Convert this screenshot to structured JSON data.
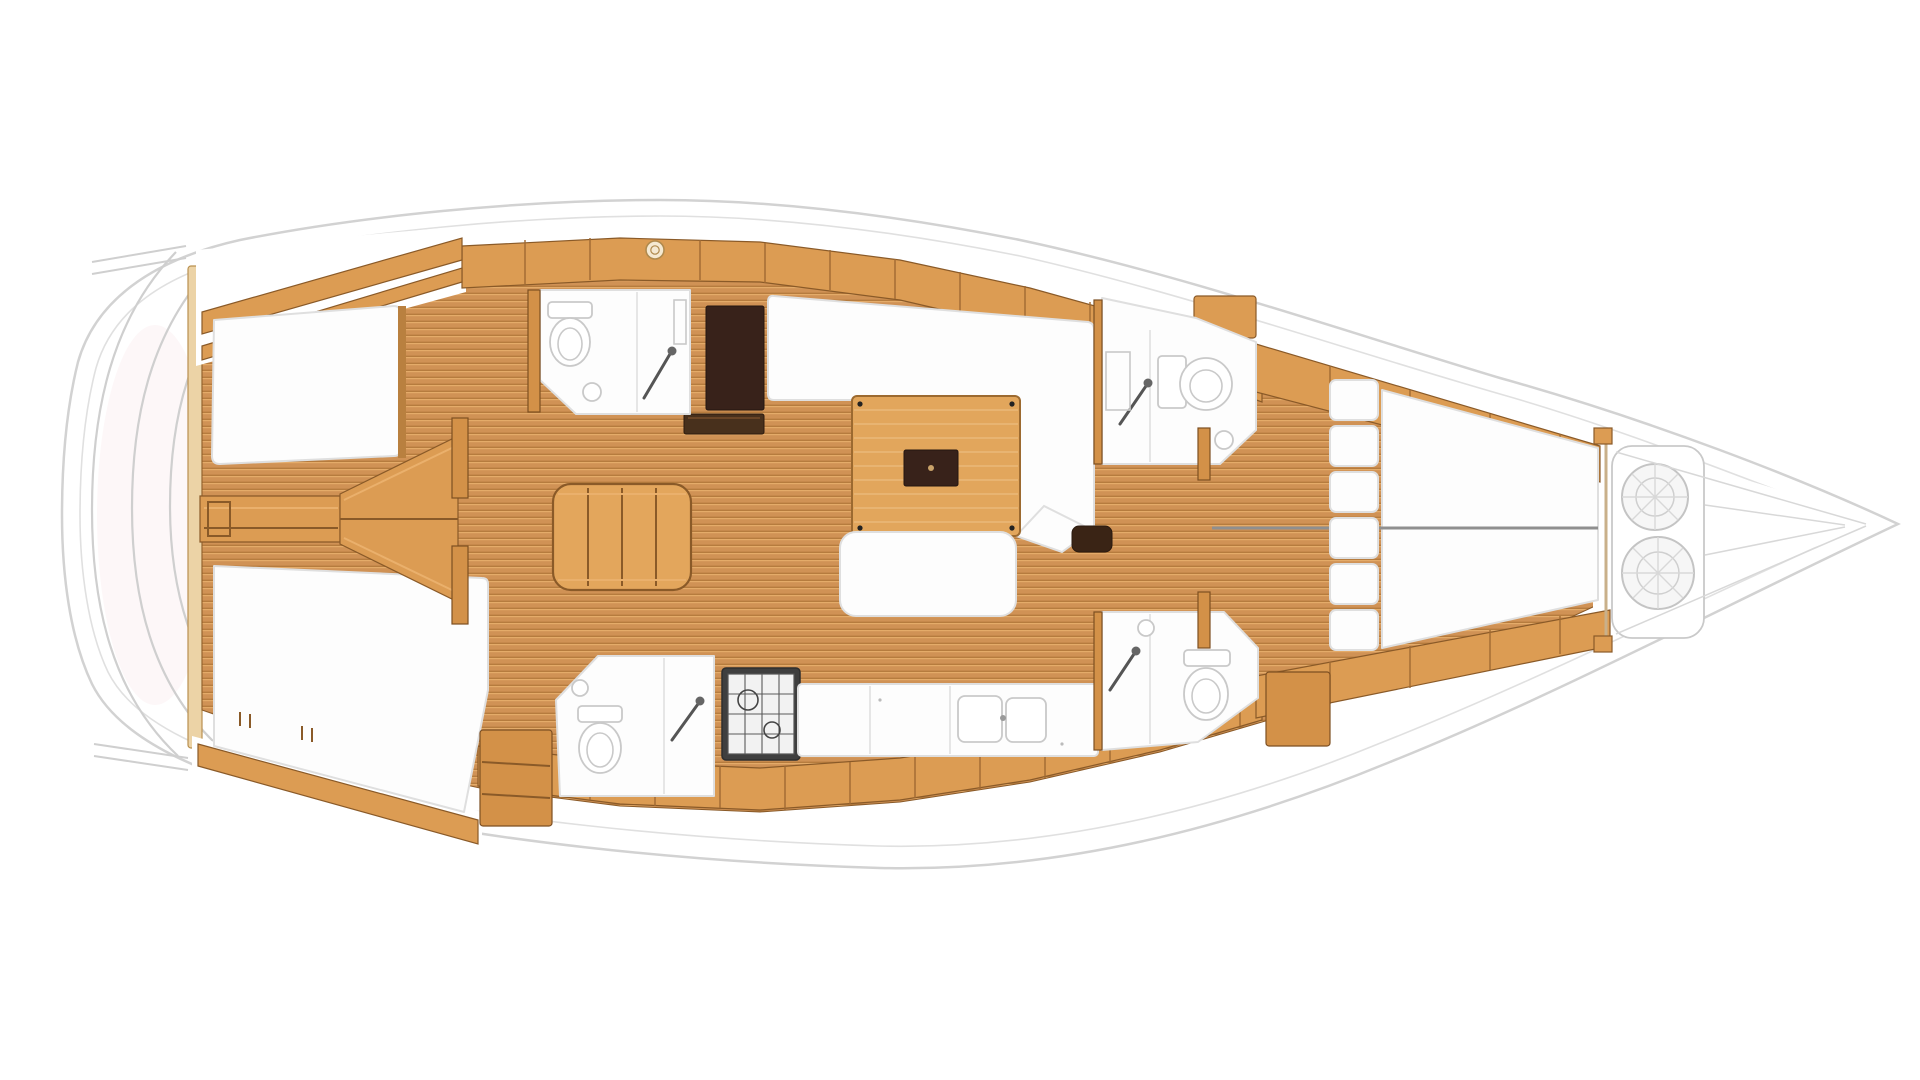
{
  "diagram": {
    "type": "yacht-interior-floorplan",
    "view": "top-down",
    "orientation": {
      "bow": "right",
      "stern": "left"
    }
  },
  "colors": {
    "background": "#ffffff",
    "hull_fill": "#ffffff",
    "hull_line": "#d2d2d2",
    "hull_line_inner": "#e0e0e0",
    "wood": "#dc9c53",
    "wood_dark": "#8a5a28",
    "wood_deep": "#7d4f22",
    "wood_light": "#eab06c",
    "plank_base": "#d09255",
    "plank_light": "#e4ab69",
    "plank_shadow": "#b67c3e",
    "furniture_white": "#fdfdfd",
    "furniture_line": "#dfdfdf",
    "fixture_line": "#c9c9c9",
    "dark_panel": "#38221a",
    "dark_step": "#3a2415",
    "stove_frame": "#3f3f3f",
    "gray_detail": "#cfcfcf",
    "tint_pink": "#fbeef0"
  },
  "features": {
    "cabins": [
      {
        "id": "aft-cabin-starboard",
        "berth": "double"
      },
      {
        "id": "aft-cabin-port",
        "berth": "double"
      },
      {
        "id": "forward-cabin",
        "berth": "v-berth-split"
      }
    ],
    "heads": [
      {
        "id": "head-amidships-starboard",
        "fixtures": [
          "toilet",
          "sink",
          "shower"
        ]
      },
      {
        "id": "head-amidships-port",
        "fixtures": [
          "toilet",
          "sink",
          "shower"
        ]
      },
      {
        "id": "head-forward-starboard",
        "fixtures": [
          "toilet",
          "sink",
          "shower"
        ]
      },
      {
        "id": "head-forward-port",
        "fixtures": [
          "toilet",
          "sink",
          "shower"
        ]
      }
    ],
    "salon": {
      "furniture": [
        "u-settee",
        "wood-table",
        "bench-seat"
      ]
    },
    "galley": {
      "equipment": [
        "stove",
        "counter",
        "double-sink"
      ]
    },
    "other": [
      "companionway-steps",
      "engine-compartment-wedge",
      "nav-dark-locker",
      "bow-rope-coils",
      "stern-transom-platform",
      "side-deck-lockers"
    ]
  }
}
